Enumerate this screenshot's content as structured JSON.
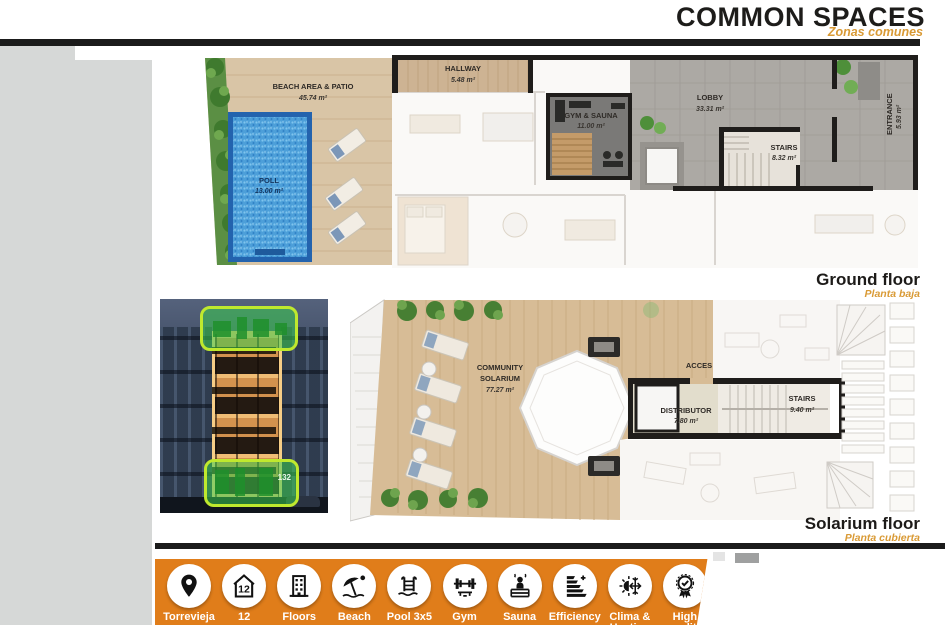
{
  "header": {
    "title": "COMMON SPACES",
    "subtitle": "Zonas comunes"
  },
  "ground": {
    "caption": "Ground floor",
    "caption_es": "Planta baja",
    "rooms": {
      "beach": {
        "name": "BEACH AREA & PATIO",
        "area": "45.74 m²"
      },
      "pool": {
        "name": "POLL",
        "area": "13.00 m²"
      },
      "hallway": {
        "name": "HALLWAY",
        "area": "5.48 m²"
      },
      "gym": {
        "name": "GYM & SAUNA",
        "area": "11.00 m²"
      },
      "lobby": {
        "name": "LOBBY",
        "area": "33.31 m²"
      },
      "stairs": {
        "name": "STAIRS",
        "area": "8.32 m²"
      },
      "entrance": {
        "name": "ENTRANCE",
        "area": "5.93 m²"
      }
    }
  },
  "solarium": {
    "caption": "Solarium floor",
    "caption_es": "Planta cubierta",
    "rooms": {
      "community": {
        "line1": "COMMUNITY",
        "line2": "SOLARIUM",
        "area": "77.27 m²"
      },
      "acces": {
        "name": "ACCES"
      },
      "distributor": {
        "name": "DISTRIBUTOR",
        "area": "7.80 m²"
      },
      "stairs": {
        "name": "STAIRS",
        "area": "9.40 m²"
      }
    }
  },
  "photo": {
    "unit_number": "132"
  },
  "features": [
    {
      "icon": "location-pin-icon",
      "label": "Torrevieja"
    },
    {
      "icon": "house-number-icon",
      "label": "12",
      "glyph_text": "12"
    },
    {
      "icon": "building-floors-icon",
      "label": "Floors"
    },
    {
      "icon": "beach-umbrella-icon",
      "label": "Beach"
    },
    {
      "icon": "pool-ladder-icon",
      "label": "Pool 3x5"
    },
    {
      "icon": "dumbbell-icon",
      "label": "Gym"
    },
    {
      "icon": "sauna-icon",
      "label": "Sauna"
    },
    {
      "icon": "energy-efficiency-icon",
      "label": "Efficiency"
    },
    {
      "icon": "climate-icon",
      "label": "Clima &",
      "label2": "Heating"
    },
    {
      "icon": "award-icon",
      "label": "High",
      "label2": "quality"
    }
  ],
  "colors": {
    "accent_orange": "#E07D1A",
    "subtitle_orange": "#D99A35",
    "highlight_green": "#3BCD4E",
    "highlight_border": "#BFE92E",
    "pool_blue": "#4D9FD9"
  }
}
